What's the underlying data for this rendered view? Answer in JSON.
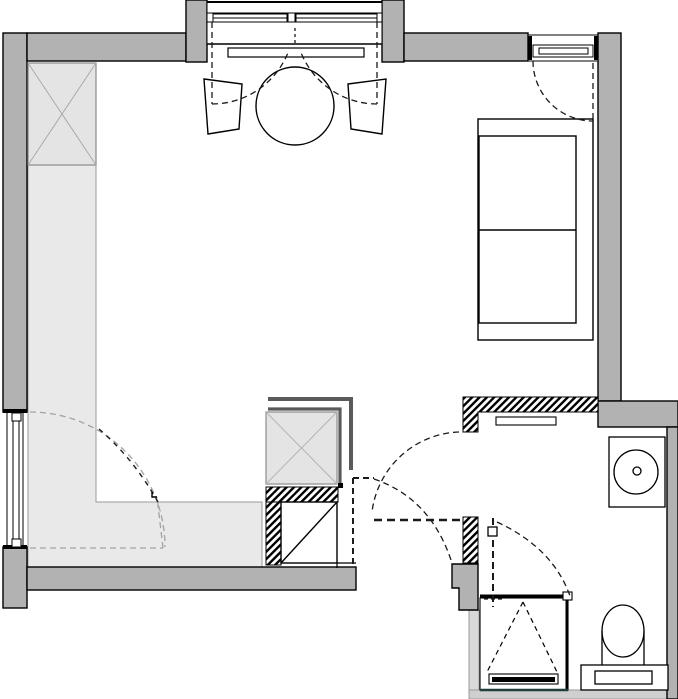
{
  "meta": {
    "title": "Studio apartment floor plan",
    "drawing_type": "architectural plan view",
    "rooms": [
      {
        "name": "main-room",
        "contents": [
          "wardrobe",
          "kitchen-counter",
          "dining-table",
          "two-chairs",
          "sofa-bed",
          "kitchen-block"
        ]
      },
      {
        "name": "vestibule",
        "contents": [
          "swing-door-a",
          "swing-door-b"
        ]
      },
      {
        "name": "bathroom",
        "contents": [
          "washbasin",
          "toilet",
          "shower",
          "wall-shelf",
          "bathroom-door"
        ]
      }
    ]
  },
  "colors": {
    "wall": "#b2b2b2",
    "wall_outline": "#000000",
    "counter_fill": "#e9e9e9",
    "counter_edge": "#9a9a9a",
    "furniture_box_fill": "#e4e4e4",
    "kitchen_dark_line": "#5a5a5a",
    "floor_strip": "#cfcfcf",
    "west_column": "#d9d9d9",
    "dash_black": "#1a1a1a",
    "dash_gray": "#a3a3a3",
    "shower_base_line": "#1f3f3e",
    "white": "#ffffff"
  },
  "fixtures": {
    "bay_window": "double casement window with table bay",
    "top_right_window": "casement window",
    "left_window": "tall window / glazed door",
    "radiator": "radiator under bay window",
    "table": "round dining table",
    "chair_left": "chair",
    "chair_right": "chair",
    "wardrobe": "wardrobe (crossed box)",
    "kitchen_counter": "L-shaped counter",
    "kitchen_block": "kitchen block with appliance (crossed box)",
    "sofa": "sofa bed with two cushions",
    "shelf": "bathroom wall shelf",
    "washbasin": "round washbasin on stand",
    "toilet": "toilet with cistern",
    "shower": "shower tray with glass screen and drain"
  }
}
